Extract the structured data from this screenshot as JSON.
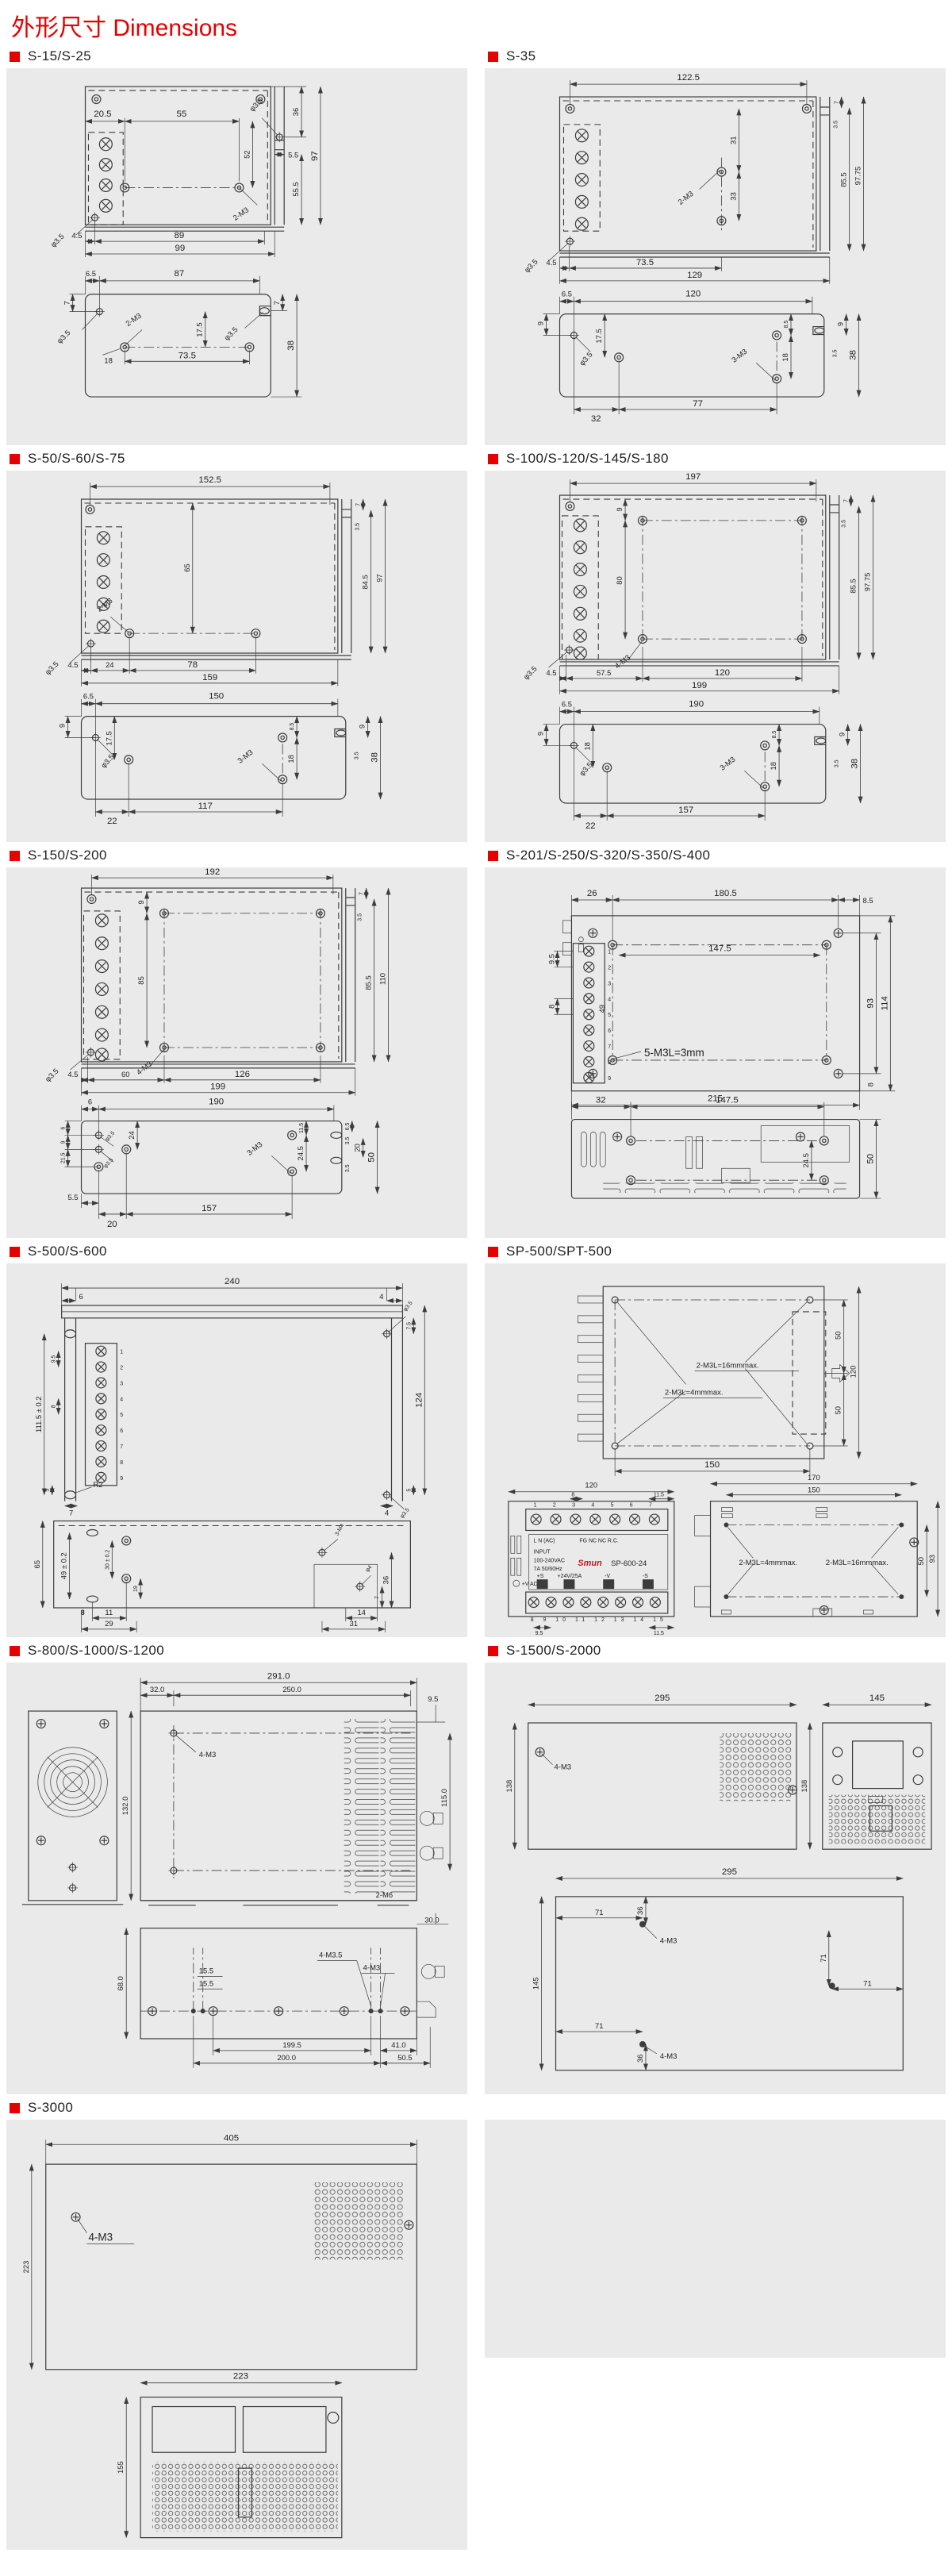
{
  "page": {
    "title": "外形尺寸 Dimensions",
    "accent": "#e60000",
    "panel_bg": "#eaeaea",
    "line_color": "#3c3c3c"
  },
  "panels": [
    {
      "label": "S-15/S-25",
      "top": {
        "w1": "20.5",
        "w2": "55",
        "v52": "52",
        "r36": "36",
        "r97": "97",
        "s55": "5.5",
        "r555": "55.5",
        "hole1": "φ3.5",
        "screw": "2-M3",
        "hole2": "φ3.5",
        "b45": "4.5",
        "b89": "89",
        "b99": "99"
      },
      "bot": {
        "t65": "6.5",
        "t87": "87",
        "l7": "7",
        "hole1": "φ3.5",
        "screw": "2-M3",
        "d18": "18",
        "v175": "17.5",
        "b735": "73.5",
        "hole2": "φ3.5",
        "r7": "7",
        "r38": "38"
      }
    },
    {
      "label": "S-35",
      "top": {
        "w": "122.5",
        "r7": "7",
        "r35": "3.5",
        "v31": "31",
        "v33": "33",
        "screw": "2-M3",
        "h855": "85.5",
        "h9775": "97.75",
        "hole": "φ3.5",
        "b45": "4.5",
        "b735": "73.5",
        "b129": "129"
      },
      "bot": {
        "t65": "6.5",
        "t120": "120",
        "l9": "9",
        "hole": "φ3.5",
        "v175": "17.5",
        "r85": "8.5",
        "r18": "18",
        "screw": "3-M3",
        "r35": "3.5",
        "r9": "9",
        "r38": "38",
        "b32": "32",
        "b77": "77"
      }
    },
    {
      "label": "S-50/S-60/S-75",
      "top": {
        "w": "152.5",
        "r7": "7",
        "r35": "3.5",
        "v65": "65",
        "screw": "2-M3",
        "h845": "84.5",
        "h97": "97",
        "hole": "φ3.5",
        "b45": "4.5",
        "b24": "24",
        "b78": "78",
        "b159": "159"
      },
      "bot": {
        "t65": "6.5",
        "t150": "150",
        "l9": "9",
        "hole": "φ3.5",
        "v175": "17.5",
        "r85": "8.5",
        "r18": "18",
        "screw": "3-M3",
        "r35": "3.5",
        "r9": "9",
        "r38": "38",
        "b22": "22",
        "b117": "117"
      }
    },
    {
      "label": "S-100/S-120/S-145/S-180",
      "top": {
        "w": "197",
        "v9": "9",
        "r7": "7",
        "r35": "3.5",
        "v80": "80",
        "screw": "4-M3",
        "h855": "85.5",
        "h9775": "97.75",
        "hole": "φ3.5",
        "b45": "4.5",
        "b575": "57.5",
        "b120": "120",
        "b199": "199"
      },
      "bot": {
        "t65": "6.5",
        "t190": "190",
        "l9": "9",
        "hole": "φ3.5",
        "v18": "18",
        "r85": "8.5",
        "r18": "18",
        "screw": "3-M3",
        "r35": "3.5",
        "r9": "9",
        "r38": "38",
        "b22": "22",
        "b157": "157"
      }
    },
    {
      "label": "S-150/S-200",
      "top": {
        "w": "192",
        "v9": "9",
        "r7": "7",
        "r35": "3.5",
        "v85": "85",
        "screw": "4-M3",
        "h855": "85.5",
        "h110": "110",
        "hole": "φ3.5",
        "b45": "4.5",
        "b60": "60",
        "b126": "126",
        "b199": "199"
      },
      "bot": {
        "t6": "6",
        "t190": "190",
        "l6": "6",
        "l9": "9",
        "l215": "21.5",
        "v24": "24",
        "holeA": "φ3.5",
        "holeB": "φ3.5",
        "screw": "3-M3",
        "r115": "11.5",
        "r245": "24.5",
        "e65": "6.5",
        "e35a": "3.5",
        "e20": "20",
        "e35b": "3.5",
        "r50": "50",
        "b55": "5.5",
        "b20": "20",
        "b157": "157"
      }
    },
    {
      "label": "S-201/S-250/S-320/S-350/S-400",
      "top": {
        "t26": "26",
        "t1805": "180.5",
        "t85": "8.5",
        "in1475": "147.5",
        "l95": "9.5",
        "l8": "8",
        "v49": "49",
        "screw": "5-M3L=3mm",
        "r93": "93",
        "r114": "114",
        "r8": "8",
        "b215": "215",
        "nums": [
          "1",
          "2",
          "3",
          "4",
          "5",
          "6",
          "7",
          "8",
          "9"
        ]
      },
      "bot": {
        "t32": "32",
        "t1475": "147.5",
        "v245": "24.5",
        "r50": "50"
      }
    },
    {
      "label": "S-500/S-600",
      "top": {
        "w": "240",
        "l6": "6",
        "r4": "4",
        "hole": "φ3.5",
        "r75": "7.5",
        "l95": "9.5",
        "l8": "8",
        "lh": "111.5 ± 0.2",
        "rh": "124",
        "rl": "R2",
        "m5a": "5",
        "m7": "7",
        "m5b": "5",
        "m4": "4",
        "holeb": "φ3.5",
        "nums": [
          "1",
          "2",
          "3",
          "4",
          "5",
          "6",
          "7",
          "8",
          "9"
        ]
      },
      "bot": {
        "l65": "65",
        "l49": "49 ± 0.2",
        "l8": "8",
        "v30": "30 ± 0.2",
        "v19": "19",
        "b11": "11",
        "b29": "29",
        "screw": "3-M4",
        "r36": "36",
        "hole4": "φ4",
        "r7": "7",
        "b14": "14",
        "b31": "31"
      }
    },
    {
      "label": "SP-500/SPT-500",
      "top": {
        "s16": "2-M3L=16mmmax.",
        "s4": "2-M3L=4mmmax.",
        "r50a": "50",
        "r50b": "50",
        "r120": "120",
        "b150": "150"
      },
      "front": {
        "w120": "120",
        "t8": "8",
        "t115": "11.5",
        "rowA": "1  2  3  4  5  6  7",
        "lblAC": "L  N  (AC)",
        "lblIO": "FG  NC  NC  R.C.",
        "input": "INPUT",
        "vac": "100-240VAC",
        "amp": "7A   50/60Hz",
        "brand": "Smun",
        "model": "SP-600-24",
        "adj": "+V ADJ.",
        "os": "+S",
        "ov": "+24V/25A",
        "om": "-V",
        "os2": "-S",
        "rowB": "8  9  10 11 12 13 14 15",
        "b95": "9.5",
        "b115": "11.5"
      },
      "back": {
        "w170": "170",
        "w150": "150",
        "s4": "2-M3L=4mmmax.",
        "s16": "2-M3L=16mmmax.",
        "r50": "50",
        "r93": "93"
      }
    },
    {
      "label": "S-800/S-1000/S-1200",
      "top": {
        "fan": "132.0",
        "w": "291.0",
        "w32": "32.0",
        "w250": "250.0",
        "r95": "9.5",
        "screw": "4-M3",
        "r115": "115.0",
        "r2m6": "2-M6"
      },
      "bot": {
        "l68": "68.0",
        "s155a": "15.5",
        "s155b": "15.5",
        "m35": "4-M3.5",
        "m3": "4-M3",
        "r30": "30.0",
        "b1995": "199.5",
        "b41": "41.0",
        "b200": "200.0",
        "b505": "50.5"
      }
    },
    {
      "label": "S-1500/S-2000",
      "top": {
        "w295": "295",
        "l138": "138",
        "screw": "4-M3",
        "w145": "145",
        "r138": "138"
      },
      "bot": {
        "w295": "295",
        "l145": "145",
        "v36a": "36",
        "h71a": "71",
        "screwA": "4-M3",
        "v71": "71",
        "h71b": "71",
        "h71c": "71",
        "v36b": "36",
        "screwB": "4-M3"
      }
    },
    {
      "label": "S-3000",
      "top": {
        "w": "405",
        "l": "223",
        "screw": "4-M3"
      },
      "bot": {
        "w": "223",
        "l": "155"
      }
    }
  ]
}
